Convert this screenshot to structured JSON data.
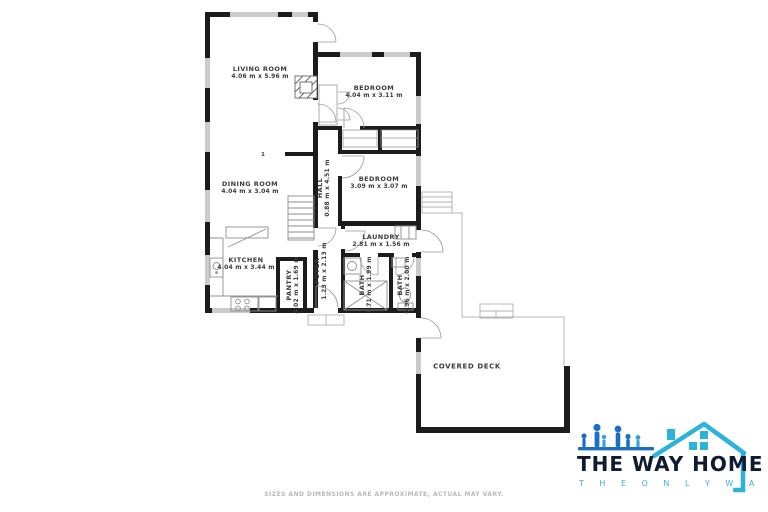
{
  "plan": {
    "rooms": [
      {
        "name": "LIVING ROOM",
        "dims": "4.06 m x 5.96 m"
      },
      {
        "name": "BEDROOM",
        "dims": "4.04 m x 3.11 m"
      },
      {
        "name": "DINING ROOM",
        "dims": "4.04 m x 3.04 m"
      },
      {
        "name": "BEDROOM",
        "dims": "3.09 m x 3.07 m"
      },
      {
        "name": "HALL",
        "dims": "0.88 m x 4.51 m"
      },
      {
        "name": "LAUNDRY",
        "dims": "2.81 m x 1.56 m"
      },
      {
        "name": "KITCHEN",
        "dims": "4.04 m x 3.44 m"
      },
      {
        "name": "FOYER",
        "dims": "1.23 m x 2.13 m"
      },
      {
        "name": "PANTRY",
        "dims": "4.02 m x 1.69 m"
      },
      {
        "name": "BATH",
        "dims": "1.71 m x 1.99 m"
      },
      {
        "name": "BATH",
        "dims": "0.96 m x 2.00 m"
      },
      {
        "name": "COVERED DECK",
        "dims": ""
      }
    ],
    "level_marker": "1",
    "wall_color": "#1c1c1c",
    "window_color": "#cbcbcb"
  },
  "footer": {
    "disclaimer": "SIZES AND DIMENSIONS ARE APPROXIMATE, ACTUAL MAY VARY."
  },
  "logo": {
    "title": "THE WAY HOME",
    "tagline": "T H E   O N L Y   W A Y",
    "colors": {
      "navy": "#101a31",
      "teal": "#2bb3da",
      "blue": "#1b6fc2"
    }
  }
}
